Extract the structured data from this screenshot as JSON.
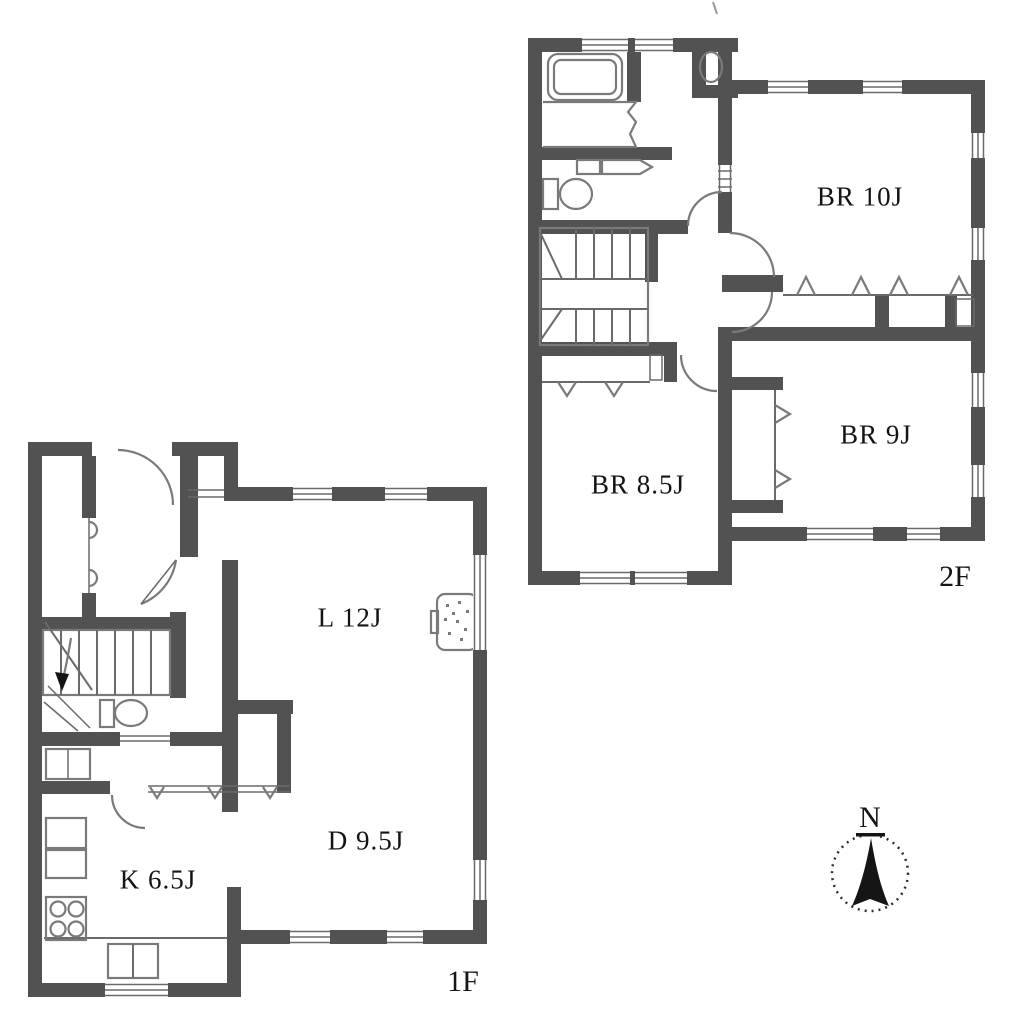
{
  "document": {
    "type": "floor-plan"
  },
  "floors": {
    "second": {
      "label": "2F",
      "rooms": [
        {
          "name": "bedroom-10j",
          "label": "BR 10J"
        },
        {
          "name": "bedroom-9j",
          "label": "BR 9J"
        },
        {
          "name": "bedroom-8-5j",
          "label": "BR 8.5J"
        }
      ]
    },
    "first": {
      "label": "1F",
      "rooms": [
        {
          "name": "living",
          "label": "L 12J"
        },
        {
          "name": "dining",
          "label": "D 9.5J"
        },
        {
          "name": "kitchen",
          "label": "K 6.5J"
        }
      ]
    }
  },
  "compass": {
    "north_label": "N"
  },
  "colors": {
    "wall": "#525252",
    "thin_line": "#6a6a6a",
    "fixture_line": "#7a7a7a",
    "text": "#141414",
    "background": "#ffffff"
  }
}
